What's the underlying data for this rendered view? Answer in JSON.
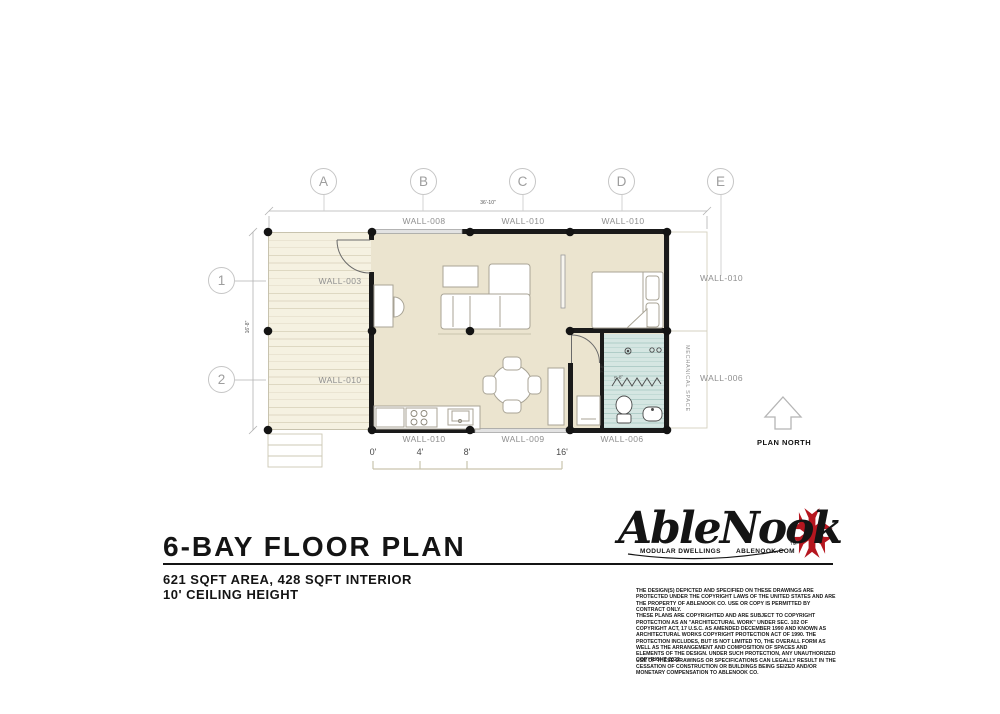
{
  "plan": {
    "grid_columns": [
      "A",
      "B",
      "C",
      "D",
      "E"
    ],
    "grid_rows": [
      "1",
      "2"
    ],
    "dim_overall_width": "36'-10\"",
    "dim_overall_depth": "16'-8\"",
    "dim_bath_depth": "7'-8\"",
    "dim_shower": "5'-0\"",
    "wall_labels_top": [
      "WALL-008",
      "WALL-010",
      "WALL-010"
    ],
    "wall_labels_bottom": [
      "WALL-010",
      "WALL-009",
      "WALL-006"
    ],
    "wall_label_deck_upper": "WALL-003",
    "wall_label_deck_lower": "WALL-010",
    "wall_label_right_upper": "WALL-010",
    "wall_label_right_lower": "WALL-006",
    "mechanical_space": "MECHANICAL SPACE",
    "plan_north": "PLAN NORTH",
    "scale_ticks": [
      "0'",
      "4'",
      "8'",
      "16'"
    ]
  },
  "title_block": {
    "title": "6-BAY FLOOR PLAN",
    "area_line": "621 SQFT AREA, 428 SQFT INTERIOR",
    "ceiling_line": "10' CEILING HEIGHT"
  },
  "branding": {
    "logo_text": "AbleNook",
    "trademark": "TM",
    "tagline_left": "MODULAR DWELLINGS",
    "tagline_right": "ABLENOOK.COM"
  },
  "legal": {
    "paragraph1": "THE DESIGN(S) DEPICTED AND SPECIFIED ON THESE DRAWINGS ARE PROTECTED UNDER THE COPYRIGHT LAWS OF THE UNITED STATES AND ARE THE PROPERTY OF ABLENOOK CO. USE OR COPY IS PERMITTED BY CONTRACT ONLY.",
    "paragraph2": "THESE PLANS ARE COPYRIGHTED AND ARE SUBJECT TO COPYRIGHT PROTECTION AS AN \"ARCHITECTURAL WORK\" UNDER SEC. 102 OF COPYRIGHT ACT, 17 U.S.C. AS AMENDED DECEMBER 1990 AND KNOWN AS ARCHITECTURAL WORKS COPYRIGHT PROTECTION ACT OF 1990. THE PROTECTION INCLUDES, BUT IS NOT LIMITED TO, THE OVERALL FORM AS WELL AS THE ARRANGEMENT AND COMPOSITION OF SPACES AND ELEMENTS OF THE DESIGN. UNDER SUCH PROTECTION, ANY UNAUTHORIZED USE OF THESE DRAWINGS OR SPECIFICATIONS CAN LEGALLY RESULT IN THE CESSATION OF CONSTRUCTION OR BUILDINGS BEING SEIZED AND/OR MONETARY COMPENSATION TO ABLENOOK CO.",
    "copyright": "COPYRIGHT 2022"
  },
  "colors": {
    "brand_red": "#b5161f",
    "floor_tan": "#ebe4cf",
    "deck_cream": "#f5f1e1",
    "bath_teal": "#d5e6e2",
    "wall_black": "#1a1a1a"
  }
}
